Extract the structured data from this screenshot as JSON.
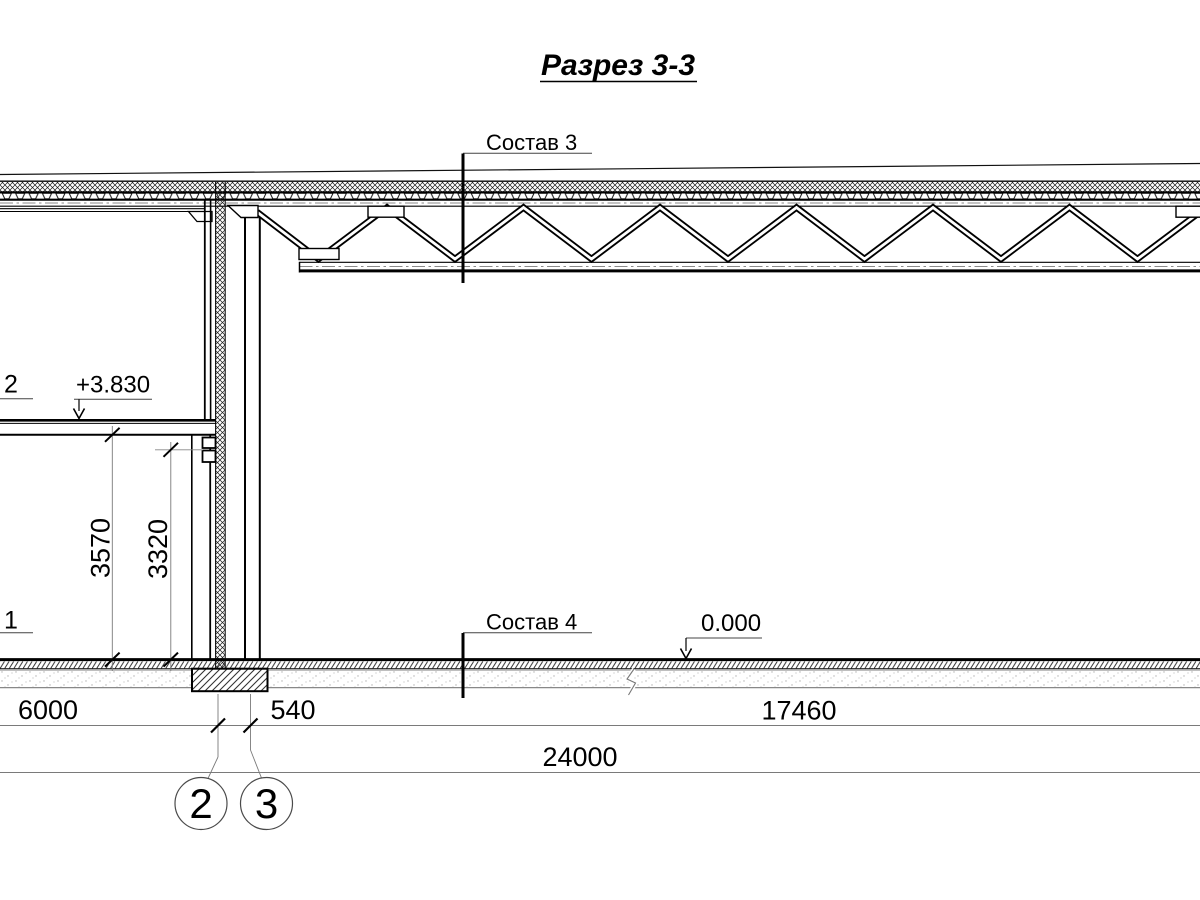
{
  "title": "Разрез 3-3",
  "labels": {
    "sostav3": "Состав 3",
    "sostav4": "Состав 4",
    "elev_upper": "+3.830",
    "elev_zero": "0.000",
    "cut_upper": "2",
    "cut_lower": "1"
  },
  "dims": {
    "span_6000": "6000",
    "span_540": "540",
    "span_17460": "17460",
    "total_24000": "24000",
    "h_3570": "3570",
    "h_3320": "3320"
  },
  "axes": {
    "axis2": "2",
    "axis3": "3"
  },
  "colors": {
    "line": "#000000",
    "dimension": "#7a7a7a",
    "centerline": "#8a8a8a",
    "background": "#ffffff"
  }
}
